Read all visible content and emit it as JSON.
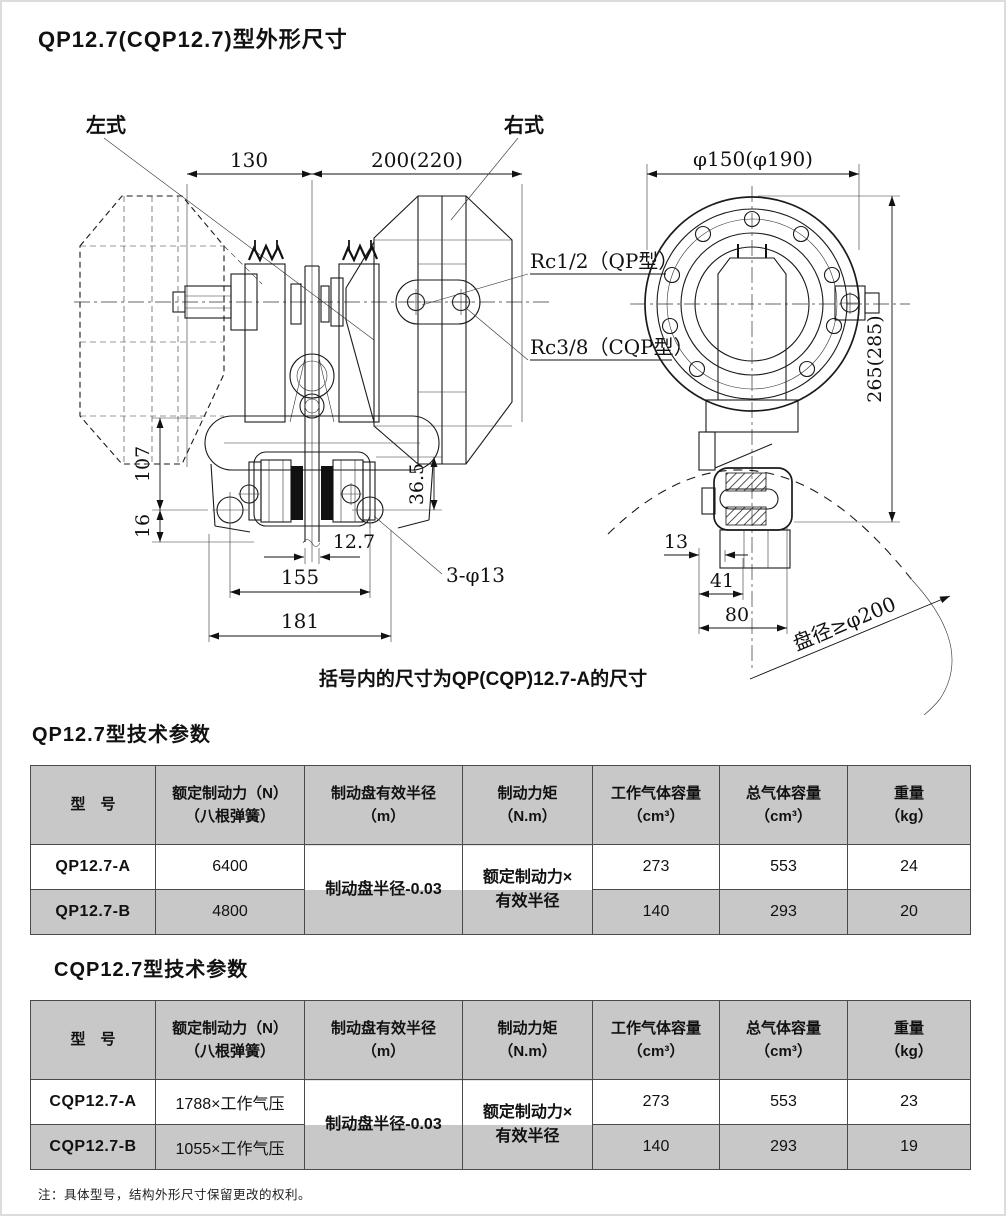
{
  "page": {
    "title": "QP12.7(CQP12.7)型外形尺寸",
    "footnote": "注：具体型号，结构外形尺寸保留更改的权利。"
  },
  "drawing": {
    "caption": "括号内的尺寸为QP(CQP)12.7-A的尺寸",
    "left_view": {
      "label_left": "左式",
      "label_right": "右式",
      "port_qp": "Rc1/2（QP型）",
      "port_cqp": "Rc3/8（CQP型）",
      "dims": {
        "d130": "130",
        "d200": "200(220)",
        "d107": "107",
        "d36_5": "36.5",
        "d16": "16",
        "d12_7": "12.7",
        "d155": "155",
        "d181": "181",
        "d3phi13": "3-φ13"
      }
    },
    "right_view": {
      "disc_note": "盘径≥φ200",
      "dims": {
        "dphi150": "φ150(φ190)",
        "d265": "265(285)",
        "d13": "13",
        "d41": "41",
        "d80": "80"
      }
    }
  },
  "table_qp": {
    "title": "QP12.7型技术参数",
    "headers": [
      {
        "l1": "型　号",
        "l2": ""
      },
      {
        "l1": "额定制动力（N）",
        "l2": "（八根弹簧）"
      },
      {
        "l1": "制动盘有效半径",
        "l2": "（m）"
      },
      {
        "l1": "制动力矩",
        "l2": "（N.m）"
      },
      {
        "l1": "工作气体容量",
        "l2": "（cm³）"
      },
      {
        "l1": "总气体容量",
        "l2": "（cm³）"
      },
      {
        "l1": "重量",
        "l2": "（kg）"
      }
    ],
    "merged": {
      "radius": "制动盘半径-0.03",
      "torque_l1": "额定制动力×",
      "torque_l2": "有效半径"
    },
    "rows": [
      {
        "model": "QP12.7-A",
        "force": "6400",
        "work_vol": "273",
        "total_vol": "553",
        "weight": "24"
      },
      {
        "model": "QP12.7-B",
        "force": "4800",
        "work_vol": "140",
        "total_vol": "293",
        "weight": "20"
      }
    ]
  },
  "table_cqp": {
    "title": "CQP12.7型技术参数",
    "headers": [
      {
        "l1": "型　号",
        "l2": ""
      },
      {
        "l1": "额定制动力（N）",
        "l2": "（八根弹簧）"
      },
      {
        "l1": "制动盘有效半径",
        "l2": "（m）"
      },
      {
        "l1": "制动力矩",
        "l2": "（N.m）"
      },
      {
        "l1": "工作气体容量",
        "l2": "（cm³）"
      },
      {
        "l1": "总气体容量",
        "l2": "（cm³）"
      },
      {
        "l1": "重量",
        "l2": "（kg）"
      }
    ],
    "merged": {
      "radius": "制动盘半径-0.03",
      "torque_l1": "额定制动力×",
      "torque_l2": "有效半径"
    },
    "rows": [
      {
        "model": "CQP12.7-A",
        "force": "1788×工作气压",
        "work_vol": "273",
        "total_vol": "553",
        "weight": "23"
      },
      {
        "model": "CQP12.7-B",
        "force": "1055×工作气压",
        "work_vol": "140",
        "total_vol": "293",
        "weight": "19"
      }
    ]
  }
}
